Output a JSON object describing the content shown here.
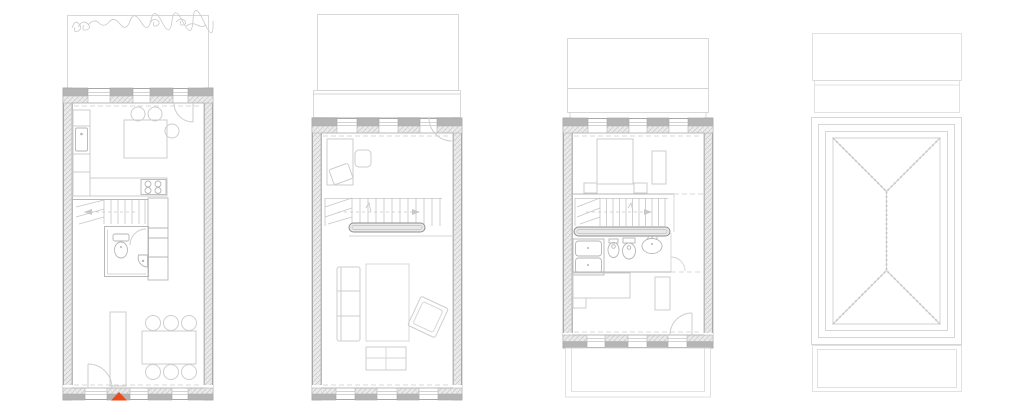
{
  "page": {
    "background": "#ffffff",
    "kind": "architectural-floor-plan-sheet",
    "view_count": 4
  },
  "colors": {
    "wall_solid": "#b5b5b5",
    "wall_outline": "#a8a8a8",
    "wall_hatch_line": "#c6c6c6",
    "furniture_line": "#cecece",
    "fixture_line": "#b6b6b6",
    "stair_line": "#c6c6c6",
    "dashed_line": "#cdcdcd",
    "roof_line": "#d2d2d2",
    "vegetation_line": "#c9c9c9",
    "handrail_line": "#8f8f8f",
    "entrance_marker": "#eb4a1c"
  },
  "plans": [
    {
      "id": "ground-floor-plan",
      "elements": [
        "garden-with-vegetation",
        "kitchen-counter",
        "kitchen-sink",
        "cooktop",
        "dining-table-4-chairs",
        "staircase",
        "bathroom",
        "toilet",
        "hand-basin",
        "storage-closets",
        "tall-cabinet",
        "dining-table-6-chairs",
        "entry-door-swing",
        "entrance-marker"
      ]
    },
    {
      "id": "first-floor-plan",
      "elements": [
        "terrace-below",
        "balcony-strip",
        "desk-with-chairs",
        "door-swing",
        "staircase",
        "stair-handrail",
        "sofa",
        "rug",
        "armchair",
        "coffee-table"
      ]
    },
    {
      "id": "second-floor-plan",
      "elements": [
        "roof-below",
        "terrace-strip",
        "double-bed",
        "wardrobe",
        "nightstands",
        "partition-wall",
        "staircase",
        "stair-handrail",
        "shower",
        "bidet",
        "toilet",
        "washbasin",
        "bed",
        "desk",
        "door-swing",
        "lower-roof-outline"
      ]
    },
    {
      "id": "roof-plan",
      "elements": [
        "upper-terrace",
        "terrace-strip",
        "hipped-roof",
        "roof-face-hatching",
        "hip-lines",
        "ridge-line",
        "lower-roof-outline"
      ]
    }
  ]
}
